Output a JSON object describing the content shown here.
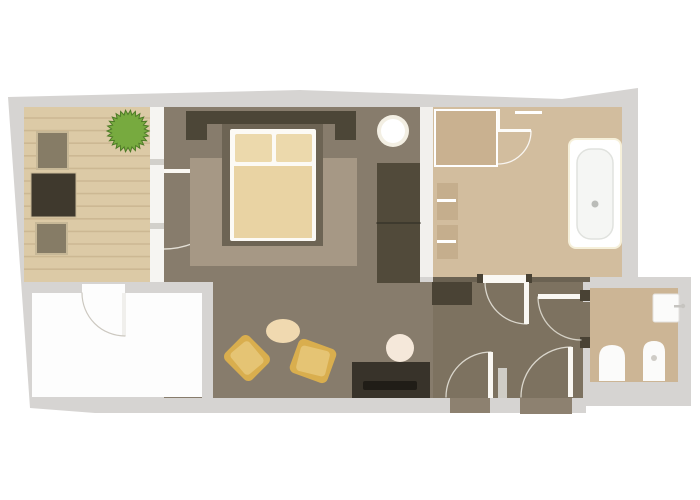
{
  "meta": {
    "description": "apartment floor plan, top-down view, no visible text",
    "canvas": {
      "width": 700,
      "height": 500,
      "background": "#ffffff"
    }
  },
  "palette": {
    "outer_wall_gray": "#d6d4d2",
    "deck_wood": "#dccaa6",
    "deck_stripe": "#ccb893",
    "bedroom_floor": "#877c6c",
    "living_floor": "#877c6c",
    "hall_floor": "#7d7260",
    "bathroom_floor": "#d2bd9e",
    "wc_floor": "#ccb595",
    "rug": "#a69885",
    "bed_platform": "#6d6454",
    "headboard_dark": "#4c4637",
    "bedding_cream": "#ecd9ac",
    "duvet_cream": "#e9d3a3",
    "cushion_gold": "#d9ae4e",
    "cushion_gold_light": "#e5c474",
    "plant_green": "#77aa3f",
    "dark_furniture": "#3f392d",
    "white_fixture": "#fbfbfa",
    "door_white": "#faf8f3",
    "threshold_wood": "#8d8170"
  },
  "rooms": [
    {
      "name": "balcony-terrace",
      "fill": "#dccaa6"
    },
    {
      "name": "bedroom",
      "fill": "#877c6c"
    },
    {
      "name": "bathroom",
      "fill": "#d2bd9e"
    },
    {
      "name": "living-area",
      "fill": "#877c6c"
    },
    {
      "name": "entry-hall",
      "fill": "#7d7260"
    },
    {
      "name": "wc-room",
      "fill": "#ccb595"
    },
    {
      "name": "empty-white-room",
      "fill": "#fdfdfd"
    }
  ],
  "elements": [
    {
      "name": "building-footprint",
      "type": "polygon",
      "points": "8,97 300,90 562,99 638,88 638,277 691,277 691,406 586,406 586,413 95,413 30,408",
      "fill": "#d6d4d2"
    },
    {
      "name": "balcony-deck",
      "type": "rect",
      "x": 24,
      "y": 107,
      "w": 128,
      "h": 175,
      "fill": "#dccaa6"
    },
    {
      "name": "balcony-deck-planks",
      "type": "stripes",
      "x": 24,
      "y": 118,
      "w": 128,
      "count": 13,
      "gap": 12.6,
      "stroke": "#ccb893",
      "sw": 1.6
    },
    {
      "name": "balcony-window-wall",
      "type": "rect",
      "x": 150,
      "y": 107,
      "w": 14,
      "h": 175,
      "fill": "#f6f5f2"
    },
    {
      "name": "window-mullion-tick-1",
      "type": "rect",
      "x": 150,
      "y": 159,
      "w": 14,
      "h": 6,
      "fill": "#d2d0cb"
    },
    {
      "name": "window-mullion-tick-2",
      "type": "rect",
      "x": 150,
      "y": 223,
      "w": 14,
      "h": 6,
      "fill": "#d2d0cb"
    },
    {
      "name": "bedroom-floor",
      "type": "rect",
      "x": 164,
      "y": 107,
      "w": 256,
      "h": 175,
      "fill": "#877c6c"
    },
    {
      "name": "bedroom-bathroom-wall",
      "type": "rect",
      "x": 420,
      "y": 107,
      "w": 13,
      "h": 170,
      "fill": "#f2f0ed"
    },
    {
      "name": "bathroom-floor",
      "type": "rect",
      "x": 433,
      "y": 107,
      "w": 189,
      "h": 170,
      "fill": "#d2bd9e"
    },
    {
      "name": "bathroom-south-wall",
      "type": "rect",
      "x": 433,
      "y": 277,
      "w": 157,
      "h": 5,
      "fill": "#6b6252"
    },
    {
      "name": "living-floor",
      "type": "rect",
      "x": 164,
      "y": 282,
      "w": 269,
      "h": 116,
      "fill": "#877c6c"
    },
    {
      "name": "hall-floor",
      "type": "rect",
      "x": 433,
      "y": 282,
      "w": 150,
      "h": 116,
      "fill": "#7d7260"
    },
    {
      "name": "wall-band-below-balcony",
      "type": "rect",
      "x": 164,
      "y": 282,
      "w": 49,
      "h": 11,
      "fill": "#d6d4d2"
    },
    {
      "name": "wall-column-white-room",
      "type": "rect",
      "x": 202,
      "y": 282,
      "w": 11,
      "h": 116,
      "fill": "#d6d4d2"
    },
    {
      "name": "empty-white-room-floor",
      "type": "rect",
      "x": 32,
      "y": 293,
      "w": 170,
      "h": 104,
      "fill": "#fdfdfd"
    },
    {
      "name": "white-room-door-opening",
      "type": "rect",
      "x": 82,
      "y": 284,
      "w": 43,
      "h": 10,
      "fill": "#fdfdfd"
    },
    {
      "name": "white-room-door-leaf",
      "type": "rect",
      "x": 122,
      "y": 293,
      "w": 4,
      "h": 43,
      "fill": "#f0efec"
    },
    {
      "name": "white-room-door-arc",
      "type": "path",
      "d": "M125,336 A43 43 0 0 1 82,293",
      "stroke": "#ccc8c0",
      "sw": 1.2
    },
    {
      "name": "wc-floor",
      "type": "rect",
      "x": 590,
      "y": 288,
      "w": 88,
      "h": 94,
      "fill": "#ccb595"
    },
    {
      "name": "wc-doorway-gap",
      "type": "rect",
      "x": 583,
      "y": 302,
      "w": 7,
      "h": 36,
      "fill": "#7d7260"
    },
    {
      "name": "balcony-door-leaf",
      "type": "rect",
      "x": 164,
      "y": 169,
      "w": 78,
      "h": 4,
      "fill": "#faf8f3"
    },
    {
      "name": "balcony-door-arc",
      "type": "path",
      "d": "M242,171 A78 78 0 0 1 164,249",
      "stroke": "rgba(250,247,240,0.8)",
      "sw": 1.4
    },
    {
      "name": "potted-plant",
      "type": "burst",
      "cx": 128,
      "cy": 131,
      "outer": 21,
      "inner": 16.5,
      "spikes": 26,
      "fill": "#77aa3f",
      "stroke": "#4e7b27",
      "sw": 1
    },
    {
      "name": "balcony-chair-top",
      "type": "rect",
      "x": 37,
      "y": 132,
      "w": 31,
      "h": 37,
      "fill": "#867c66",
      "stroke": "#c7b897",
      "sw": 2
    },
    {
      "name": "balcony-table",
      "type": "rect",
      "x": 31,
      "y": 173,
      "w": 45,
      "h": 44,
      "fill": "#3f392d",
      "stroke": "#c7b897",
      "sw": 1
    },
    {
      "name": "balcony-chair-bottom",
      "type": "rect",
      "x": 36,
      "y": 223,
      "w": 31,
      "h": 31,
      "fill": "#867c66",
      "stroke": "#c7b897",
      "sw": 2
    },
    {
      "name": "bedroom-rug",
      "type": "rect",
      "x": 190,
      "y": 158,
      "w": 167,
      "h": 108,
      "fill": "#a69885"
    },
    {
      "name": "headboard-bar",
      "type": "rect",
      "x": 186,
      "y": 111,
      "w": 170,
      "h": 13,
      "fill": "#4c4637"
    },
    {
      "name": "headboard-left-post",
      "type": "rect",
      "x": 186,
      "y": 111,
      "w": 21,
      "h": 29,
      "fill": "#4c4637"
    },
    {
      "name": "headboard-right-post",
      "type": "rect",
      "x": 335,
      "y": 111,
      "w": 21,
      "h": 29,
      "fill": "#4c4637"
    },
    {
      "name": "bed-platform",
      "type": "rect",
      "x": 222,
      "y": 124,
      "w": 101,
      "h": 122,
      "fill": "#6d6454"
    },
    {
      "name": "bed-frame",
      "type": "rect",
      "x": 230,
      "y": 129,
      "w": 86,
      "h": 112,
      "rx": 2,
      "fill": "#fcfaf5"
    },
    {
      "name": "bed-pillow-left",
      "type": "rect",
      "x": 235,
      "y": 134,
      "w": 37,
      "h": 28,
      "rx": 2,
      "fill": "#ecd9ac"
    },
    {
      "name": "bed-pillow-right",
      "type": "rect",
      "x": 276,
      "y": 134,
      "w": 36,
      "h": 28,
      "rx": 2,
      "fill": "#ecd9ac"
    },
    {
      "name": "bed-duvet",
      "type": "rect",
      "x": 234,
      "y": 166,
      "w": 78,
      "h": 72,
      "fill": "#e9d3a3"
    },
    {
      "name": "bedside-lamp-glow",
      "type": "circle",
      "cx": 393,
      "cy": 131,
      "r": 16,
      "fill": "#f3efe3"
    },
    {
      "name": "bedside-lamp",
      "type": "circle",
      "cx": 393,
      "cy": 131,
      "r": 12,
      "fill": "#ffffff"
    },
    {
      "name": "wardrobe",
      "type": "rect",
      "x": 377,
      "y": 163,
      "w": 43,
      "h": 120,
      "fill": "#514a3a"
    },
    {
      "name": "wardrobe-divider",
      "type": "path",
      "d": "M377,223 L420,223",
      "stroke": "#39342a",
      "sw": 1.5
    },
    {
      "name": "shower-tray",
      "type": "rect",
      "x": 435,
      "y": 110,
      "w": 62,
      "h": 56,
      "fill": "#c9b190",
      "stroke": "#ffffff",
      "sw": 2
    },
    {
      "name": "towel-rail",
      "type": "rect",
      "x": 515,
      "y": 111,
      "w": 27,
      "h": 3,
      "fill": "#ffffff"
    },
    {
      "name": "bathroom-door-jamb",
      "type": "rect",
      "x": 497,
      "y": 109,
      "w": 3,
      "h": 23,
      "fill": "#fdfcf9"
    },
    {
      "name": "bathroom-door-leaf",
      "type": "rect",
      "x": 497,
      "y": 129,
      "w": 34,
      "h": 3,
      "fill": "#fdfcf9"
    },
    {
      "name": "bathroom-door-arc",
      "type": "path",
      "d": "M531,131 A33 33 0 0 1 498,164",
      "stroke": "rgba(255,255,255,0.85)",
      "sw": 1.3
    },
    {
      "name": "vanity-shelf-top",
      "type": "rect",
      "x": 437,
      "y": 183,
      "w": 21,
      "h": 37,
      "fill": "#c5ae8d"
    },
    {
      "name": "vanity-shelf-top-line",
      "type": "rect",
      "x": 437,
      "y": 199,
      "w": 19,
      "h": 3,
      "fill": "#ffffff"
    },
    {
      "name": "vanity-shelf-bottom",
      "type": "rect",
      "x": 437,
      "y": 225,
      "w": 21,
      "h": 34,
      "fill": "#c5ae8d"
    },
    {
      "name": "vanity-shelf-bottom-line",
      "type": "rect",
      "x": 437,
      "y": 240,
      "w": 19,
      "h": 3,
      "fill": "#ffffff"
    },
    {
      "name": "bathtub-halo",
      "type": "rect",
      "x": 568,
      "y": 138,
      "w": 54,
      "h": 111,
      "rx": 8,
      "fill": "#f6f0da"
    },
    {
      "name": "bathtub-outer",
      "type": "rect",
      "x": 570,
      "y": 140,
      "w": 50,
      "h": 107,
      "rx": 6,
      "fill": "#ffffff"
    },
    {
      "name": "bathtub-inner",
      "type": "rect",
      "x": 577,
      "y": 149,
      "w": 36,
      "h": 90,
      "rx": 14,
      "fill": "#f5f6f4",
      "stroke": "#e0e2de",
      "sw": 1.5
    },
    {
      "name": "bathtub-drain",
      "type": "circle",
      "cx": 595,
      "cy": 204,
      "r": 3.5,
      "fill": "#babcb8"
    },
    {
      "name": "hall-dresser",
      "type": "rect",
      "x": 432,
      "y": 282,
      "w": 40,
      "h": 23,
      "fill": "#4a4335"
    },
    {
      "name": "bath-hall-threshold",
      "type": "rect",
      "x": 482,
      "y": 275,
      "w": 45,
      "h": 8,
      "fill": "#faf8f3"
    },
    {
      "name": "bath-hall-hinge-left",
      "type": "rect",
      "x": 477,
      "y": 274,
      "w": 6,
      "h": 9,
      "fill": "#494234"
    },
    {
      "name": "bath-hall-hinge-right",
      "type": "rect",
      "x": 526,
      "y": 274,
      "w": 6,
      "h": 9,
      "fill": "#494234"
    },
    {
      "name": "bath-hall-door-leaf",
      "type": "rect",
      "x": 524,
      "y": 282,
      "w": 5,
      "h": 42,
      "fill": "#faf8f3"
    },
    {
      "name": "bath-hall-door-arc",
      "type": "path",
      "d": "M527,324 A42 42 0 0 1 485,282",
      "stroke": "rgba(250,248,240,0.75)",
      "sw": 1.3
    },
    {
      "name": "wc-door-leaf",
      "type": "rect",
      "x": 538,
      "y": 294,
      "w": 44,
      "h": 5,
      "fill": "#faf8f3"
    },
    {
      "name": "wc-door-hinge-top",
      "type": "rect",
      "x": 580,
      "y": 290,
      "w": 10,
      "h": 11,
      "fill": "#494234"
    },
    {
      "name": "wc-door-hinge-bottom",
      "type": "rect",
      "x": 580,
      "y": 337,
      "w": 10,
      "h": 11,
      "fill": "#494234"
    },
    {
      "name": "wc-door-arc",
      "type": "path",
      "d": "M538,297 A43 43 0 0 0 581,340",
      "stroke": "rgba(250,248,240,0.7)",
      "sw": 1.3
    },
    {
      "name": "entrance-door-1-leaf",
      "type": "rect",
      "x": 488,
      "y": 352,
      "w": 5,
      "h": 46,
      "fill": "#faf8f3"
    },
    {
      "name": "entrance-door-1-arc",
      "type": "path",
      "d": "M491,352 A45 45 0 0 0 446,397",
      "stroke": "rgba(250,248,240,0.75)",
      "sw": 1.3
    },
    {
      "name": "entrance-threshold-1",
      "type": "rect",
      "x": 450,
      "y": 398,
      "w": 40,
      "h": 15,
      "fill": "#8d8170"
    },
    {
      "name": "entry-wall-stub",
      "type": "rect",
      "x": 498,
      "y": 368,
      "w": 9,
      "h": 30,
      "fill": "#cfcdc6"
    },
    {
      "name": "entrance-door-2-leaf",
      "type": "rect",
      "x": 568,
      "y": 347,
      "w": 5,
      "h": 50,
      "fill": "#faf8f3"
    },
    {
      "name": "entrance-door-2-arc",
      "type": "path",
      "d": "M571,347 A50 50 0 0 0 521,397",
      "stroke": "rgba(250,248,240,0.75)",
      "sw": 1.3
    },
    {
      "name": "entrance-threshold-2",
      "type": "rect",
      "x": 520,
      "y": 398,
      "w": 52,
      "h": 16,
      "fill": "#8d8170"
    },
    {
      "name": "tv-cabinet",
      "type": "rect",
      "x": 352,
      "y": 362,
      "w": 78,
      "h": 36,
      "fill": "#38332a"
    },
    {
      "name": "tv-cabinet-drawer",
      "type": "rect",
      "x": 363,
      "y": 381,
      "w": 54,
      "h": 9,
      "rx": 2,
      "fill": "#201d17"
    },
    {
      "name": "living-side-table",
      "type": "circle",
      "cx": 400,
      "cy": 348,
      "r": 14,
      "fill": "#f5e8da"
    },
    {
      "name": "living-pouf-oval",
      "type": "ellipse",
      "cx": 283,
      "cy": 331,
      "rx": 17,
      "ry": 12,
      "fill": "#f0d9b0"
    },
    {
      "name": "floor-cushion-1",
      "type": "rect",
      "x": 228,
      "y": 341,
      "w": 38,
      "h": 34,
      "rx": 6,
      "fill": "#d9ae4e",
      "rotate": [
        45,
        247,
        358
      ]
    },
    {
      "name": "floor-cushion-1-top",
      "type": "rect",
      "x": 233,
      "y": 346,
      "w": 28,
      "h": 24,
      "rx": 4,
      "fill": "#e5c474",
      "rotate": [
        50,
        247,
        358
      ]
    },
    {
      "name": "floor-cushion-2",
      "type": "rect",
      "x": 293,
      "y": 343,
      "w": 40,
      "h": 36,
      "rx": 6,
      "fill": "#d9ae4e",
      "rotate": [
        20,
        313,
        361
      ]
    },
    {
      "name": "floor-cushion-2-top",
      "type": "rect",
      "x": 298,
      "y": 348,
      "w": 30,
      "h": 26,
      "rx": 4,
      "fill": "#e5c474",
      "rotate": [
        14,
        313,
        361
      ]
    },
    {
      "name": "wc-sink",
      "type": "rect",
      "x": 653,
      "y": 294,
      "w": 26,
      "h": 28,
      "rx": 2,
      "fill": "#fbfbfa",
      "stroke": "#e3e1dd",
      "sw": 1
    },
    {
      "name": "wc-sink-faucet",
      "type": "rect",
      "x": 674,
      "y": 305,
      "w": 9,
      "h": 2.5,
      "fill": "#c6c4c0"
    },
    {
      "name": "wc-sink-faucet-knob",
      "type": "circle",
      "cx": 683,
      "cy": 306,
      "r": 2.2,
      "fill": "#c6c4c0"
    },
    {
      "name": "wc-toilet",
      "type": "arch",
      "x": 599,
      "y": 345,
      "w": 26,
      "h": 36,
      "fill": "#fbfbfa"
    },
    {
      "name": "wc-bidet",
      "type": "arch",
      "x": 643,
      "y": 341,
      "w": 22,
      "h": 40,
      "fill": "#fbfbfa"
    },
    {
      "name": "wc-bidet-drain",
      "type": "circle",
      "cx": 654,
      "cy": 358,
      "r": 3,
      "fill": "#cfccc6"
    }
  ]
}
